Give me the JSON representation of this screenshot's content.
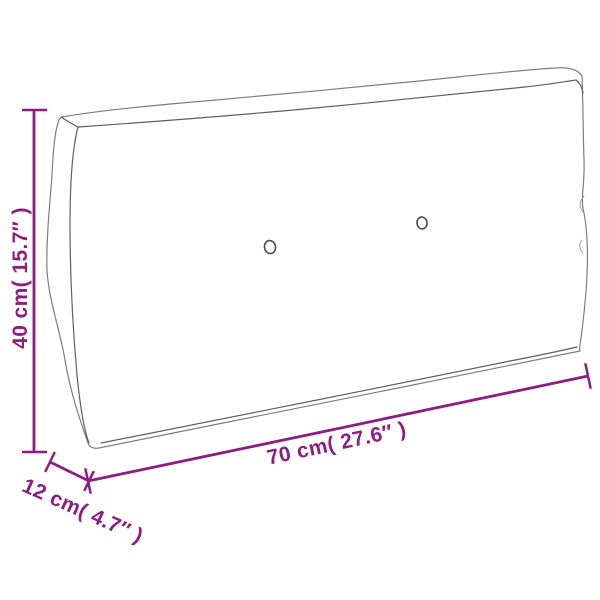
{
  "canvas": {
    "width": 600,
    "height": 600,
    "background_color": "#ffffff"
  },
  "diagram": {
    "kind": "product-dimension-drawing",
    "subject": "pallet-cushion-outline",
    "accent_color": "#8e1d7f",
    "outline_color": "#7d7d7d",
    "buttons_visible": 2,
    "dimensions": {
      "height": {
        "label": "40 cm( 15.7″ )",
        "cm": "40",
        "inches": "15.7"
      },
      "width": {
        "label": "70 cm( 27.6″ )",
        "cm": "70",
        "inches": "27.6"
      },
      "depth": {
        "label": "12 cm( 4.7″ )",
        "cm": "12",
        "inches": "4.7"
      }
    }
  }
}
